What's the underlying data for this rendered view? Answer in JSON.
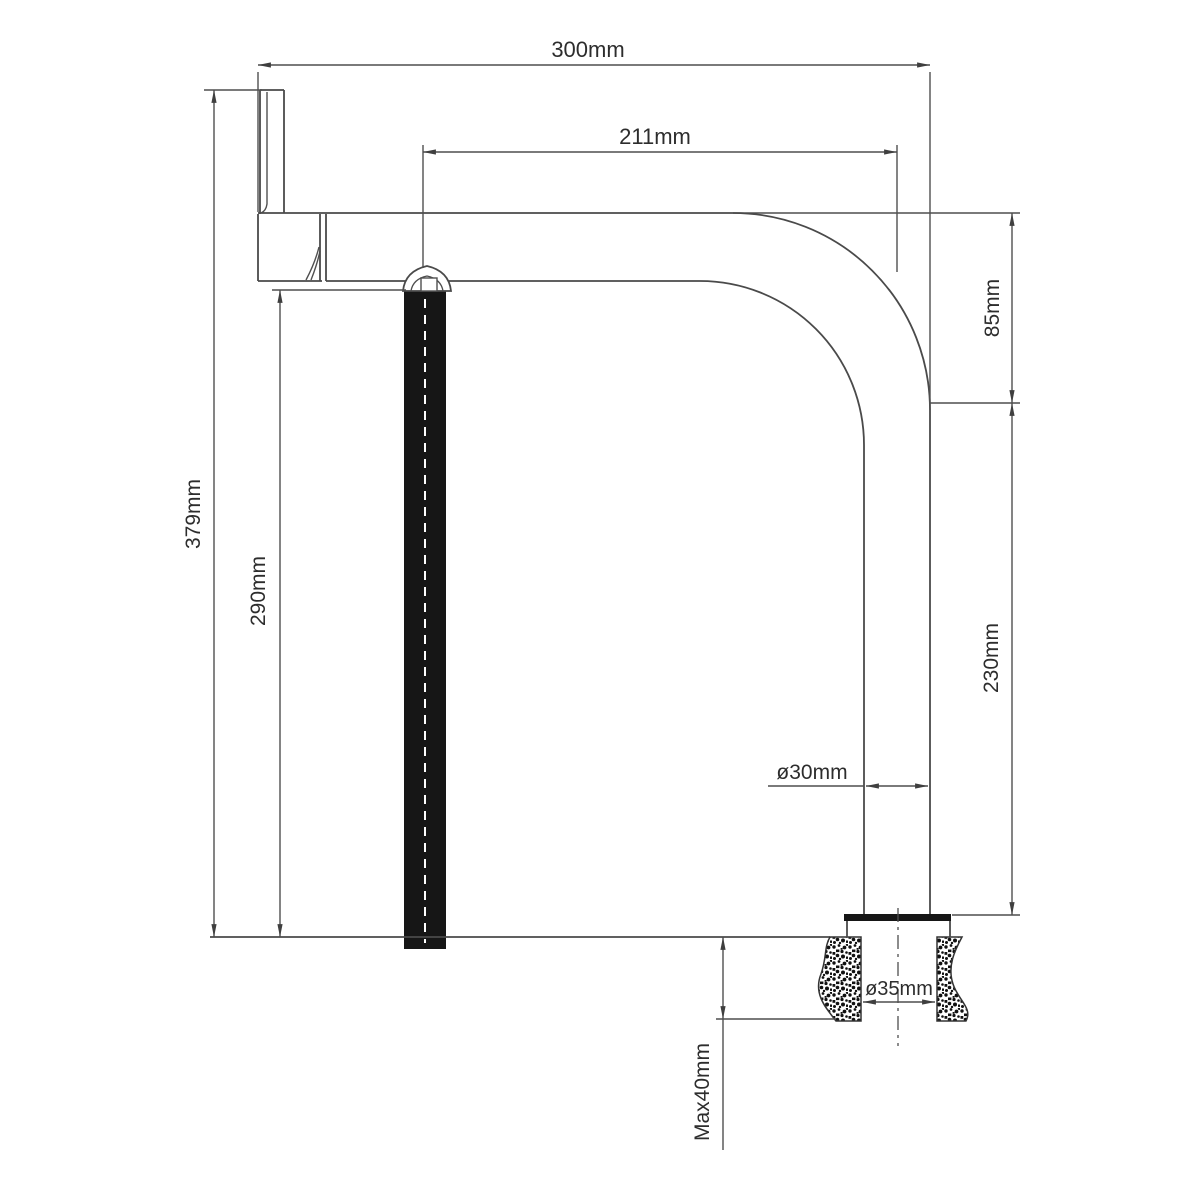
{
  "drawing": {
    "title": "faucet-installation-dimension-drawing",
    "unit": "mm",
    "dimensions": {
      "overall_reach": "300mm",
      "outlet_reach": "211mm",
      "curve_height": "85mm",
      "riser_height": "230mm",
      "total_height": "379mm",
      "outlet_height": "290mm",
      "pipe_diameter": "ø30mm",
      "hole_diameter": "ø35mm",
      "max_deck_thickness": "Max40mm"
    },
    "colors": {
      "line": "#4a4a4a",
      "text": "#2d2d2d",
      "solid_part": "#161616",
      "background": "#ffffff"
    }
  }
}
